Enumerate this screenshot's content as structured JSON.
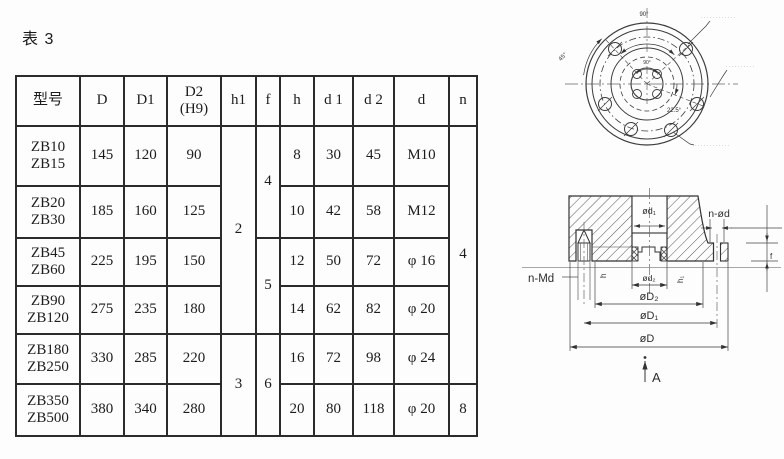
{
  "page": {
    "title": "表 3"
  },
  "table": {
    "header": {
      "model": "型号",
      "D": "D",
      "D1": "D1",
      "D2_line1": "D2",
      "D2_line2": "(H9)",
      "h1": "h1",
      "f": "f",
      "h": "h",
      "d1": "d 1",
      "d2": "d 2",
      "d": "d",
      "n": "n"
    },
    "rows": [
      {
        "m1": "ZB10",
        "m2": "ZB15",
        "D": "145",
        "D1": "120",
        "D2": "90",
        "h": "8",
        "d1": "30",
        "d2": "45",
        "d": "M10"
      },
      {
        "m1": "ZB20",
        "m2": "ZB30",
        "D": "185",
        "D1": "160",
        "D2": "125",
        "h": "10",
        "d1": "42",
        "d2": "58",
        "d": "M12"
      },
      {
        "m1": "ZB45",
        "m2": "ZB60",
        "D": "225",
        "D1": "195",
        "D2": "150",
        "h": "12",
        "d1": "50",
        "d2": "72",
        "d": "φ 16"
      },
      {
        "m1": "ZB90",
        "m2": "ZB120",
        "D": "275",
        "D1": "235",
        "D2": "180",
        "h": "14",
        "d1": "62",
        "d2": "82",
        "d": "φ 20"
      },
      {
        "m1": "ZB180",
        "m2": "ZB250",
        "D": "330",
        "D1": "285",
        "D2": "220",
        "h": "16",
        "d1": "72",
        "d2": "98",
        "d": "φ 24"
      },
      {
        "m1": "ZB350",
        "m2": "ZB500",
        "D": "380",
        "D1": "340",
        "D2": "280",
        "h": "20",
        "d1": "80",
        "d2": "118",
        "d": "φ 20"
      }
    ],
    "merged": {
      "h1_top": "2",
      "h1_bottom": "3",
      "f_top": "4",
      "f_mid": "5",
      "f_bottom": "6",
      "n_top": "4",
      "n_bottom": "8"
    }
  },
  "drawings": {
    "front_view": {
      "angle_90": "90°",
      "angle_45": "45°",
      "angle_225": "22.5°",
      "angle_90_small": "90°",
      "note_top": "············",
      "note_right": "··········",
      "note_bottom": "············"
    },
    "section_view": {
      "d1": "ød₁",
      "d2": "ød₂",
      "D2": "øD₂",
      "D1": "øD₁",
      "D": "øD",
      "n_md": "n-Md",
      "n_od": "n-ød",
      "h": "h",
      "h1": "h₁",
      "f": "f",
      "view_arrow": "A"
    }
  }
}
